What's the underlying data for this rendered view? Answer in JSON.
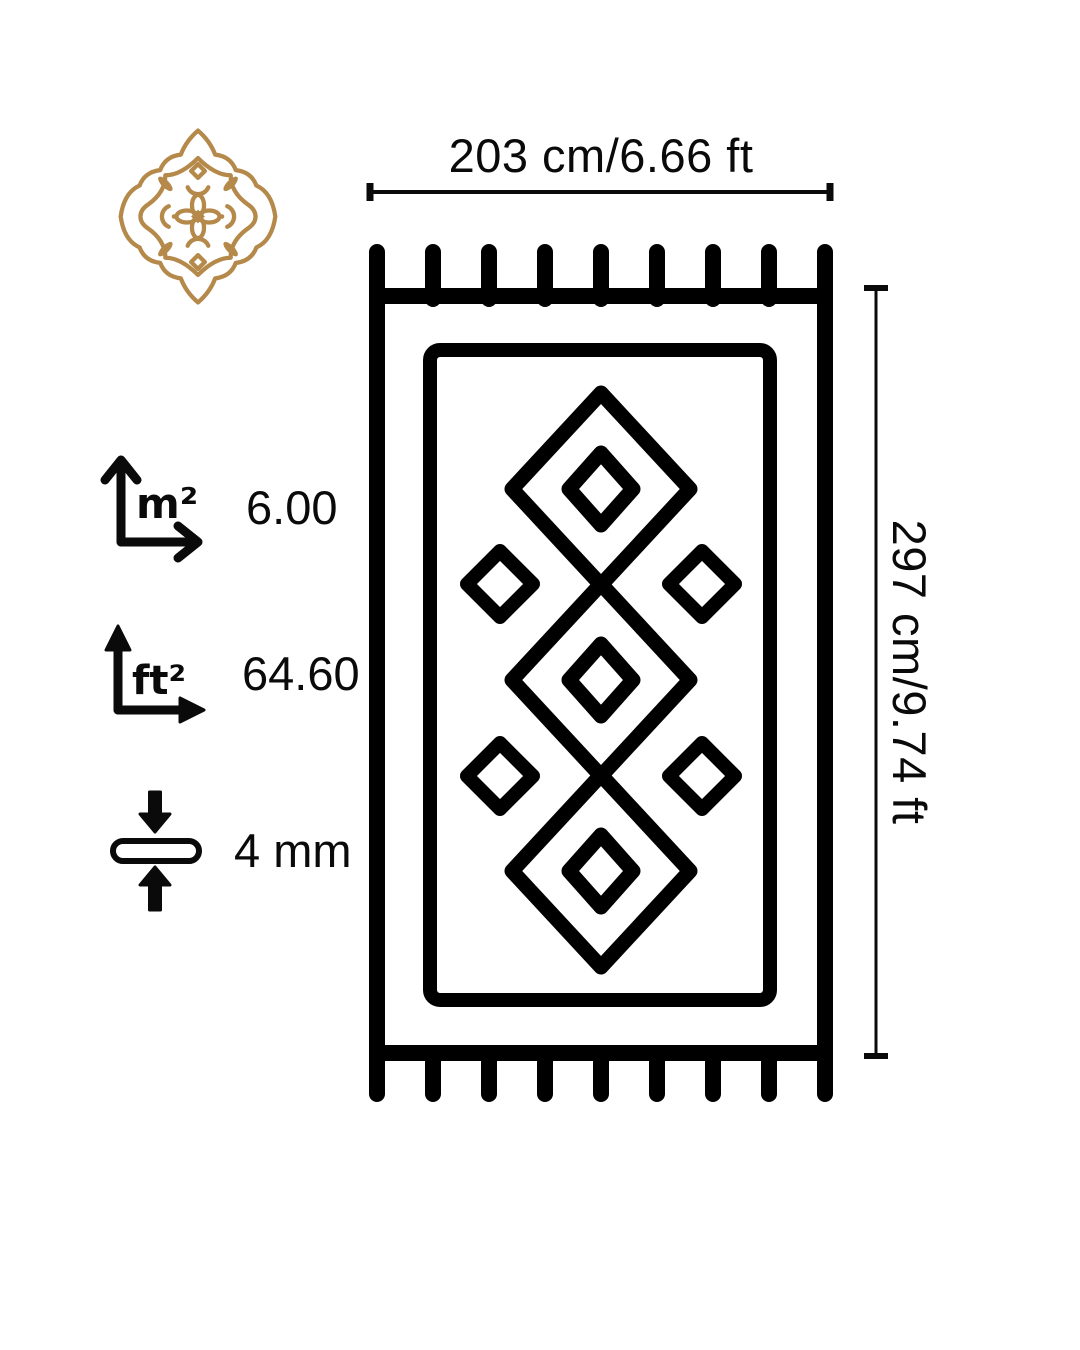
{
  "theme": {
    "background": "#ffffff",
    "ink": "#0a0a0a",
    "gold": "#b5894a"
  },
  "dimensions": {
    "width_label": "203 cm/6.66 ft",
    "height_label": "297 cm/9.74 ft"
  },
  "specs": {
    "area_m2": {
      "unit": "m²",
      "value": "6.00"
    },
    "area_ft2": {
      "unit": "ft²",
      "value": "64.60"
    },
    "thickness": {
      "value": "4 mm"
    }
  },
  "icons": {
    "medallion": "gold-ornamental-medallion-logo",
    "area_m2": "xy-arrows-m2-icon",
    "area_ft2": "xy-arrows-ft2-icon",
    "thickness": "pile-thickness-arrows-icon",
    "rug": "rug-with-fringe-diagram"
  }
}
